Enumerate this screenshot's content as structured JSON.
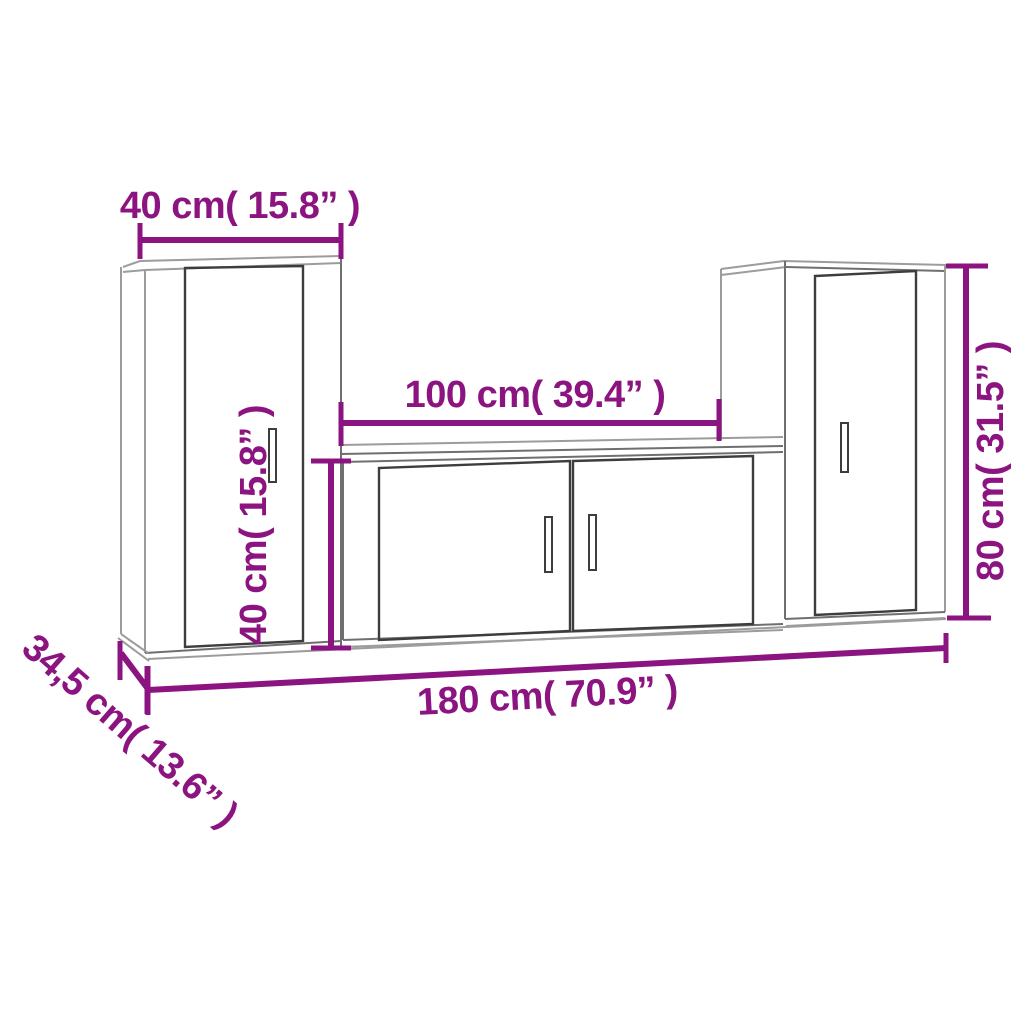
{
  "colors": {
    "dimension": "#8C1480",
    "outline_dark": "#3d3d3d",
    "outline_med": "#6f6f6f",
    "outline_light": "#9c9c9c",
    "background": "#ffffff"
  },
  "diagram": {
    "kind": "furniture-dimension-diagram",
    "pieces": [
      "left-tall-cabinet",
      "middle-low-cabinet",
      "right-tall-cabinet"
    ]
  },
  "measurements": {
    "left_cabinet_width": {
      "label": "40 cm( 15.8” )",
      "cm": "40",
      "inches": "15.8"
    },
    "middle_cabinet_width": {
      "label": "100 cm( 39.4” )",
      "cm": "100",
      "inches": "39.4"
    },
    "middle_cabinet_height": {
      "label": "40 cm( 15.8” )",
      "cm": "40",
      "inches": "15.8"
    },
    "right_cabinet_height": {
      "label": "80 cm( 31.5” )",
      "cm": "80",
      "inches": "31.5"
    },
    "total_width": {
      "label": "180 cm( 70.9” )",
      "cm": "180",
      "inches": "70.9"
    },
    "depth": {
      "label": "34,5 cm( 13.6” )",
      "cm": "34,5",
      "inches": "13.6"
    }
  }
}
